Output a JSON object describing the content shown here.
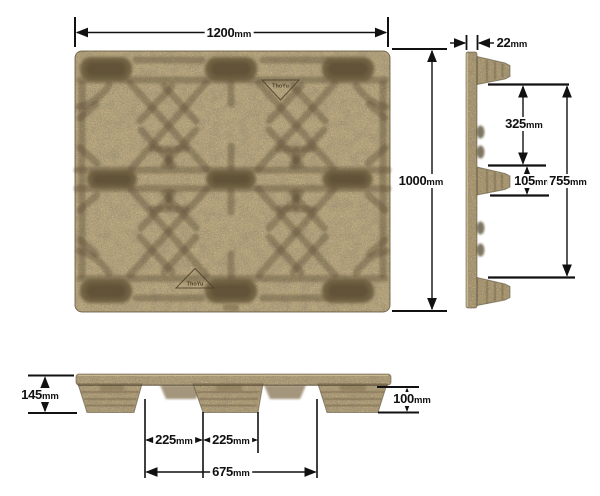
{
  "drawing": {
    "brand_mark": "ThoYu",
    "dimensions": {
      "length": {
        "value": "1200",
        "unit": "mm"
      },
      "width": {
        "value": "1000",
        "unit": "mm"
      },
      "deck_thickness": {
        "value": "22",
        "unit": "mm"
      },
      "fork_opening": {
        "value": "325",
        "unit": "mm"
      },
      "center_foot": {
        "value": "105",
        "unit": "mm"
      },
      "inner_span": {
        "value": "755",
        "unit": "mm"
      },
      "overall_height": {
        "value": "145",
        "unit": "mm"
      },
      "foot_height": {
        "value": "100",
        "unit": "mm"
      },
      "foot_gap_left": {
        "value": "225",
        "unit": "mm"
      },
      "foot_gap_right": {
        "value": "225",
        "unit": "mm"
      },
      "bottom_span": {
        "value": "675",
        "unit": "mm"
      }
    },
    "colors": {
      "surface": "#b3a27a",
      "recess": "#675941",
      "profile": "#a6956f",
      "dimension_line": "#111111",
      "background": "#ffffff"
    }
  }
}
